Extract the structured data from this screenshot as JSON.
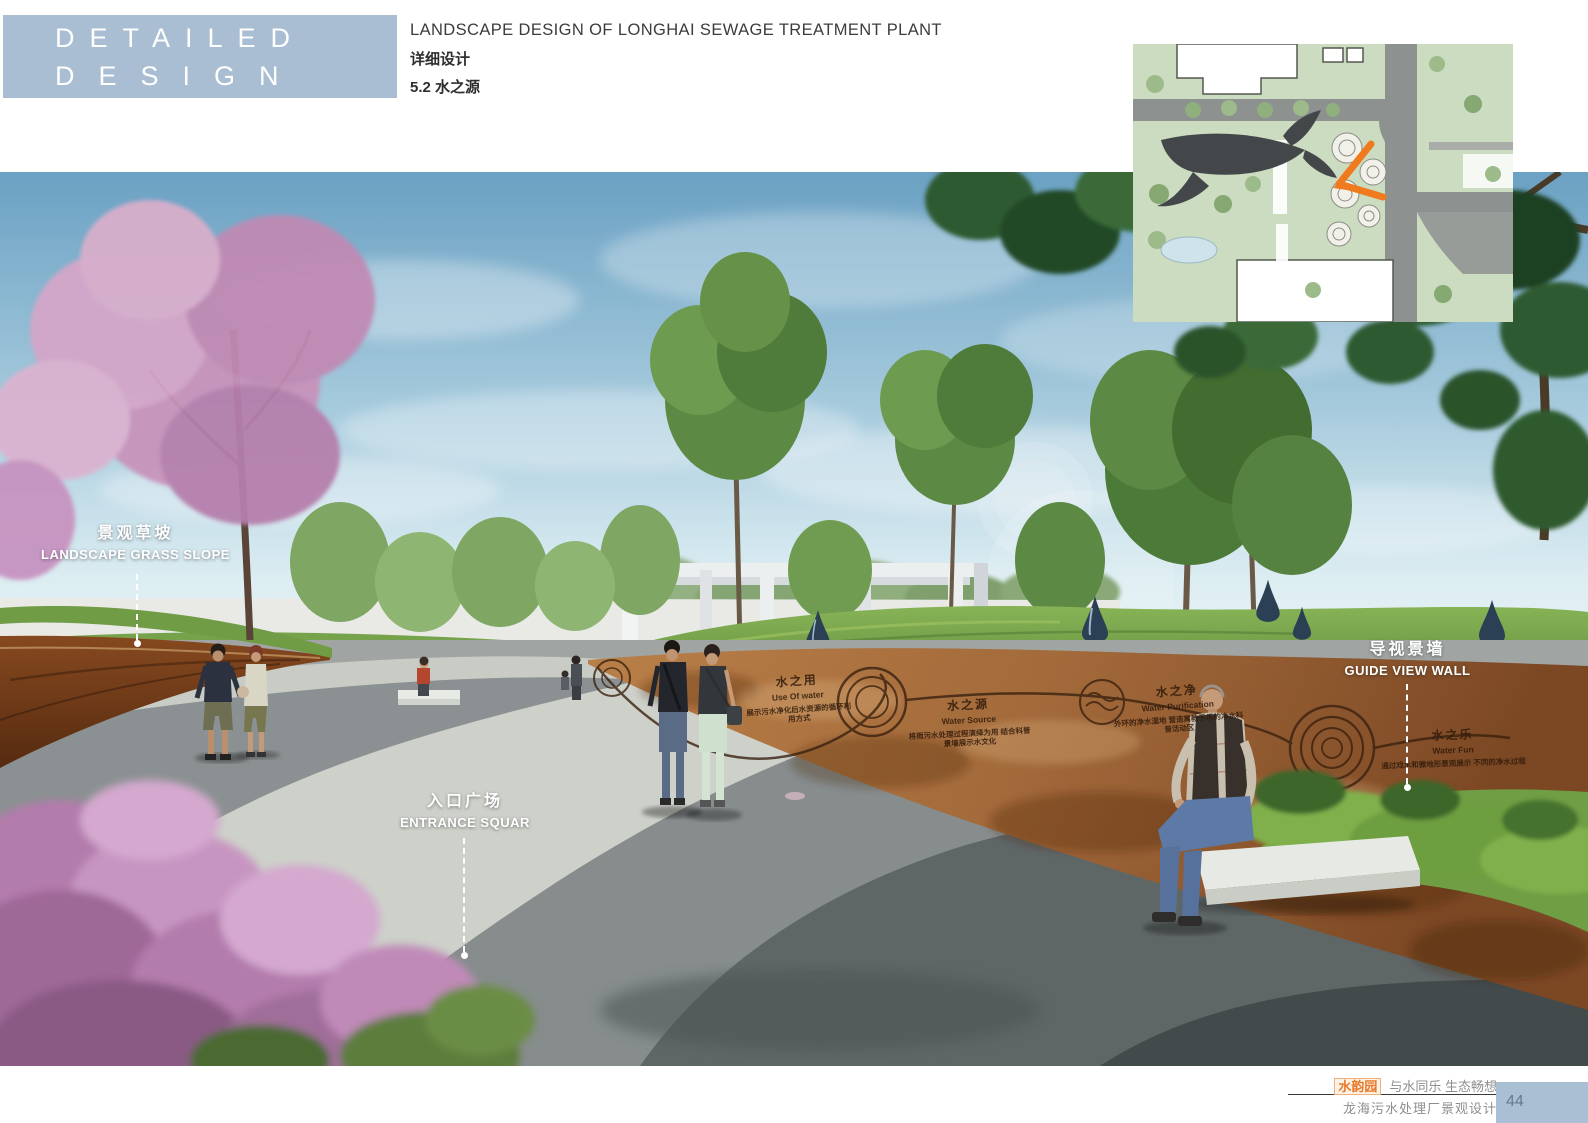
{
  "header": {
    "series_line1": "DETAILED",
    "series_line2": "DESIGN",
    "title_en": "LANDSCAPE DESIGN OF LONGHAI SEWAGE TREATMENT PLANT",
    "title_cn": "详细设计",
    "section": "5.2 水之源"
  },
  "annotations": [
    {
      "id": "landscape-grass-slope",
      "cn": "景观草坡",
      "en": "LANDSCAPE GRASS SLOPE"
    },
    {
      "id": "entrance-square",
      "cn": "入口广场",
      "en": "ENTRANCE SQUAR"
    },
    {
      "id": "guide-view-wall",
      "cn": "导视景墙",
      "en": "GUIDE VIEW WALL"
    }
  ],
  "wall_inscriptions": [
    {
      "cn": "水之用",
      "en": "Use Of water",
      "desc": "展示污水净化后水资源的循环利用方式"
    },
    {
      "cn": "水之源",
      "en": "Water Source",
      "desc": "将雨污水处理过程演绎为用 结合科普景墙展示水文化"
    },
    {
      "cn": "水之净",
      "en": "Water Purification",
      "desc": "外环的净水湿地 营造寓教于乐的净水科普活动区"
    },
    {
      "cn": "水之乐",
      "en": "Water Fun",
      "desc": "通过戏水和微地形景观展示 不同的净水过程"
    }
  ],
  "footer": {
    "brand": "水韵园",
    "tagline": "与水同乐 生态畅想",
    "project": "龙海污水处理厂景观设计",
    "page_number": "44"
  },
  "colors": {
    "header_box": "#a9bed2",
    "accent_orange": "#e8792a",
    "page_box": "#a9c0d4",
    "sky": "#6ba1c3",
    "corten": "#a2693a",
    "grass": "#6f9e44",
    "pavement": "#a0a5a4",
    "flowers": "#b27cac"
  }
}
